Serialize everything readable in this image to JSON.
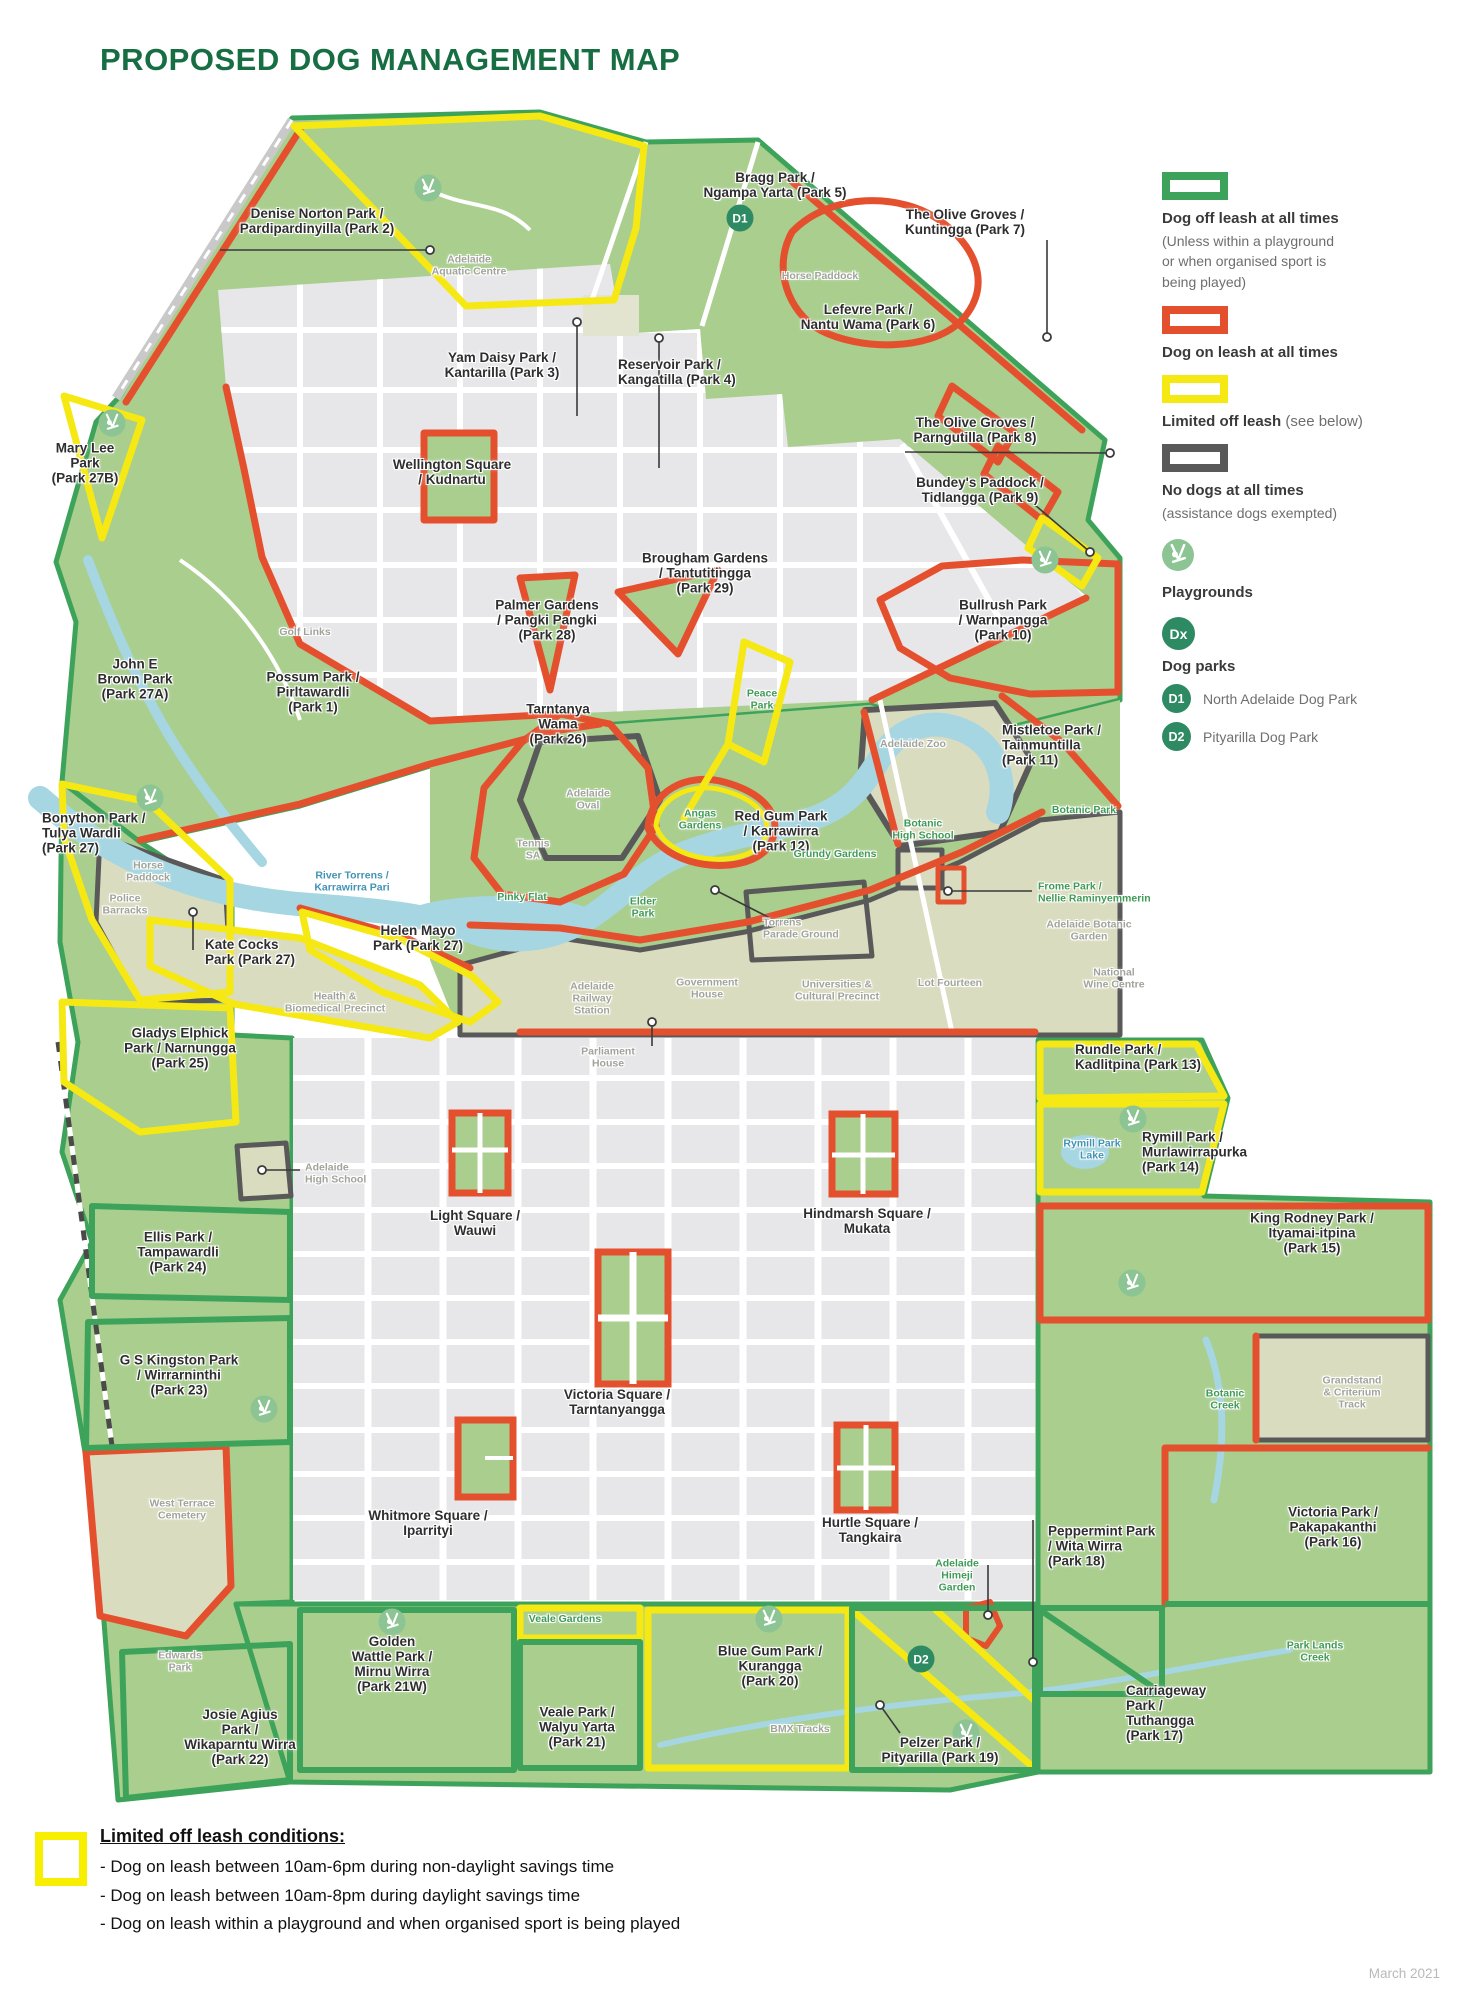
{
  "title": "PROPOSED DOG MANAGEMENT MAP",
  "legend": {
    "off_leash_label": "Dog off leash at all times",
    "off_leash_note": "(Unless within a playground\nor when organised sport is\nbeing played)",
    "on_leash_label": "Dog on leash at all times",
    "limited_label": "Limited off leash",
    "limited_note": " (see below)",
    "no_dogs_label": "No dogs at all times",
    "no_dogs_note": "(assistance dogs exempted)",
    "playgrounds_label": "Playgrounds",
    "dog_parks_badge": "Dx",
    "dog_parks_label": "Dog parks",
    "dog_parks": [
      {
        "badge": "D1",
        "label": "North Adelaide Dog Park"
      },
      {
        "badge": "D2",
        "label": "Pityarilla Dog Park"
      }
    ]
  },
  "footer": {
    "heading": "Limited off leash conditions:",
    "lines": [
      "- Dog on leash between 10am-6pm during non-daylight savings time",
      "- Dog on leash between 10am-8pm during daylight savings time",
      "- Dog on leash within a playground and when organised sport is being played"
    ],
    "date": "March 2021"
  },
  "colors": {
    "off_leash": "#3ea35a",
    "on_leash": "#e4502e",
    "limited": "#f6e813",
    "no_dogs": "#595959",
    "park_fill": "#a9ce8e",
    "water": "#a5d6e2"
  },
  "map_labels": [
    {
      "name": "label-denise-norton",
      "cls": "park",
      "x": 317,
      "y": 221,
      "text": "Denise Norton Park /\nPardipardinyilla (Park 2)"
    },
    {
      "name": "label-bragg",
      "cls": "park",
      "x": 775,
      "y": 185,
      "text": "Bragg Park /\nNgampa Yarta (Park 5)"
    },
    {
      "name": "label-olive-groves-kuntingga",
      "cls": "park",
      "x": 965,
      "y": 222,
      "text": "The Olive Groves /\nKuntingga (Park 7)"
    },
    {
      "name": "label-yam-daisy",
      "cls": "park",
      "x": 502,
      "y": 365,
      "text": "Yam Daisy Park /\nKantarilla (Park 3)"
    },
    {
      "name": "label-reservoir",
      "cls": "park",
      "x": 618,
      "y": 372,
      "align": "left",
      "text": "Reservoir Park /\nKangatilla (Park 4)"
    },
    {
      "name": "label-lefevre",
      "cls": "park",
      "x": 868,
      "y": 317,
      "text": "Lefevre Park /\nNantu Wama (Park 6)"
    },
    {
      "name": "label-olive-groves-parngutilla",
      "cls": "park",
      "x": 975,
      "y": 430,
      "text": "The Olive Groves /\nParngutilla (Park 8)"
    },
    {
      "name": "label-bundeys-paddock",
      "cls": "park",
      "x": 980,
      "y": 490,
      "text": "Bundey's Paddock /\nTidlangga (Park 9)"
    },
    {
      "name": "label-mary-lee",
      "cls": "park",
      "x": 85,
      "y": 463,
      "text": "Mary Lee\nPark\n(Park 27B)"
    },
    {
      "name": "label-wellington-square",
      "cls": "park",
      "x": 452,
      "y": 472,
      "text": "Wellington Square\n/ Kudnartu"
    },
    {
      "name": "label-brougham-gardens",
      "cls": "park",
      "x": 705,
      "y": 573,
      "text": "Brougham Gardens\n/ Tantutitingga\n(Park 29)"
    },
    {
      "name": "label-palmer-gardens",
      "cls": "park",
      "x": 547,
      "y": 620,
      "text": "Palmer Gardens\n/ Pangki Pangki\n(Park 28)"
    },
    {
      "name": "label-bullrush",
      "cls": "park",
      "x": 1003,
      "y": 620,
      "text": "Bullrush Park\n/ Warnpangga\n(Park 10)"
    },
    {
      "name": "label-john-e-brown",
      "cls": "park",
      "x": 135,
      "y": 679,
      "text": "John E\nBrown Park\n(Park 27A)"
    },
    {
      "name": "label-possum",
      "cls": "park",
      "x": 313,
      "y": 692,
      "text": "Possum Park /\nPirltawardli\n(Park 1)"
    },
    {
      "name": "label-tarntanya-wama",
      "cls": "park",
      "x": 558,
      "y": 724,
      "text": "Tarntanya\nWama\n(Park 26)"
    },
    {
      "name": "label-mistletoe",
      "cls": "park",
      "x": 1002,
      "y": 745,
      "align": "left",
      "text": "Mistletoe Park /\nTainmuntilla\n(Park 11)"
    },
    {
      "name": "label-bonython",
      "cls": "park",
      "x": 42,
      "y": 833,
      "align": "left",
      "text": "Bonython Park /\nTulya Wardli\n(Park 27)"
    },
    {
      "name": "label-red-gum",
      "cls": "park",
      "x": 781,
      "y": 831,
      "text": "Red Gum Park\n/ Karrawirra\n(Park 12)"
    },
    {
      "name": "label-kate-cocks",
      "cls": "park",
      "x": 205,
      "y": 952,
      "align": "left",
      "text": "Kate Cocks\nPark (Park 27)"
    },
    {
      "name": "label-helen-mayo",
      "cls": "park",
      "x": 418,
      "y": 938,
      "text": "Helen Mayo\nPark (Park 27)"
    },
    {
      "name": "label-gladys-elphick",
      "cls": "park",
      "x": 180,
      "y": 1048,
      "text": "Gladys Elphick\nPark / Narnungga\n(Park 25)"
    },
    {
      "name": "label-rundle",
      "cls": "park",
      "x": 1075,
      "y": 1057,
      "align": "left",
      "text": "Rundle Park /\nKadlitpina (Park 13)"
    },
    {
      "name": "label-rymill",
      "cls": "park",
      "x": 1142,
      "y": 1152,
      "align": "left",
      "text": "Rymill Park /\nMurlawirrapurka\n(Park 14)"
    },
    {
      "name": "label-light-square",
      "cls": "park",
      "x": 475,
      "y": 1223,
      "text": "Light Square /\nWauwi"
    },
    {
      "name": "label-hindmarsh-square",
      "cls": "park",
      "x": 867,
      "y": 1221,
      "text": "Hindmarsh Square /\nMukata"
    },
    {
      "name": "label-ellis",
      "cls": "park",
      "x": 178,
      "y": 1252,
      "text": "Ellis Park /\nTampawardli\n(Park 24)"
    },
    {
      "name": "label-king-rodney",
      "cls": "park",
      "x": 1312,
      "y": 1233,
      "text": "King Rodney Park /\nItyamai-itpina\n(Park 15)"
    },
    {
      "name": "label-gs-kingston",
      "cls": "park",
      "x": 179,
      "y": 1375,
      "text": "G S Kingston Park\n/ Wirrarninthi\n(Park 23)"
    },
    {
      "name": "label-victoria-square",
      "cls": "park",
      "x": 617,
      "y": 1402,
      "text": "Victoria Square /\nTarntanyangga"
    },
    {
      "name": "label-whitmore-square",
      "cls": "park",
      "x": 428,
      "y": 1523,
      "text": "Whitmore Square /\nIparrityi"
    },
    {
      "name": "label-hurtle-square",
      "cls": "park",
      "x": 870,
      "y": 1530,
      "text": "Hurtle Square /\nTangkaira"
    },
    {
      "name": "label-peppermint",
      "cls": "park",
      "x": 1048,
      "y": 1546,
      "align": "left",
      "text": "Peppermint Park\n/ Wita Wirra\n(Park 18)"
    },
    {
      "name": "label-victoria-park",
      "cls": "park",
      "x": 1333,
      "y": 1527,
      "text": "Victoria Park /\nPakapakanthi\n(Park 16)"
    },
    {
      "name": "label-golden-wattle",
      "cls": "park",
      "x": 392,
      "y": 1664,
      "text": "Golden\nWattle Park /\nMirnu Wirra\n(Park 21W)"
    },
    {
      "name": "label-blue-gum",
      "cls": "park",
      "x": 770,
      "y": 1666,
      "text": "Blue Gum Park /\nKurangga\n(Park 20)"
    },
    {
      "name": "label-veale-park",
      "cls": "park",
      "x": 577,
      "y": 1727,
      "text": "Veale Park /\nWalyu Yarta\n(Park 21)"
    },
    {
      "name": "label-carriageway",
      "cls": "park",
      "x": 1126,
      "y": 1713,
      "align": "left",
      "text": "Carriageway\nPark /\nTuthangga\n(Park 17)"
    },
    {
      "name": "label-josie-agius",
      "cls": "park",
      "x": 240,
      "y": 1737,
      "text": "Josie Agius\nPark /\nWikaparntu Wirra\n(Park 22)"
    },
    {
      "name": "label-pelzer",
      "cls": "park",
      "x": 940,
      "y": 1750,
      "text": "Pelzer Park /\nPityarilla (Park 19)"
    },
    {
      "name": "label-peace-park",
      "cls": "green",
      "x": 762,
      "y": 700,
      "text": "Peace\nPark"
    },
    {
      "name": "label-botanic-park",
      "cls": "green",
      "x": 1084,
      "y": 811,
      "text": "Botanic Park"
    },
    {
      "name": "label-angas-gardens",
      "cls": "green",
      "x": 700,
      "y": 820,
      "text": "Angas\nGardens"
    },
    {
      "name": "label-grundy-gardens",
      "cls": "green",
      "x": 835,
      "y": 855,
      "text": "Grundy Gardens"
    },
    {
      "name": "label-botanic-high-school",
      "cls": "green",
      "x": 923,
      "y": 830,
      "text": "Botanic\nHigh School"
    },
    {
      "name": "label-frome-park",
      "cls": "green",
      "x": 1038,
      "y": 893,
      "align": "left",
      "text": "Frome Park /\nNellie Raminyemmerin"
    },
    {
      "name": "label-pinky-flat",
      "cls": "green",
      "x": 522,
      "y": 898,
      "text": "Pinky Flat"
    },
    {
      "name": "label-elder-park",
      "cls": "green",
      "x": 643,
      "y": 908,
      "text": "Elder\nPark"
    },
    {
      "name": "label-veale-gardens",
      "cls": "green",
      "x": 565,
      "y": 1620,
      "text": "Veale Gardens"
    },
    {
      "name": "label-himeji-garden",
      "cls": "green",
      "x": 957,
      "y": 1576,
      "text": "Adelaide\nHimeji\nGarden"
    },
    {
      "name": "label-park-lands-creek",
      "cls": "green",
      "x": 1315,
      "y": 1652,
      "text": "Park Lands\nCreek"
    },
    {
      "name": "label-botanic-creek",
      "cls": "green",
      "x": 1225,
      "y": 1400,
      "text": "Botanic\nCreek"
    },
    {
      "name": "label-river-torrens",
      "cls": "blue",
      "x": 352,
      "y": 882,
      "text": "River Torrens /\nKarrawirra Pari"
    },
    {
      "name": "label-rymill-lake",
      "cls": "blue",
      "x": 1092,
      "y": 1150,
      "text": "Rymill Park\nLake"
    },
    {
      "name": "label-aquatic-centre",
      "cls": "gray",
      "x": 469,
      "y": 266,
      "text": "Adelaide\nAquatic Centre"
    },
    {
      "name": "label-horse-paddock-north",
      "cls": "gray",
      "x": 820,
      "y": 277,
      "text": "Horse Paddock"
    },
    {
      "name": "label-golf-links",
      "cls": "gray",
      "x": 305,
      "y": 633,
      "text": "Golf Links"
    },
    {
      "name": "label-adelaide-zoo",
      "cls": "gray",
      "x": 913,
      "y": 745,
      "text": "Adelaide Zoo"
    },
    {
      "name": "label-adelaide-oval",
      "cls": "gray",
      "x": 588,
      "y": 800,
      "text": "Adelaide\nOval"
    },
    {
      "name": "label-tennis-sa",
      "cls": "gray",
      "x": 533,
      "y": 850,
      "text": "Tennis\nSA"
    },
    {
      "name": "label-horse-paddock-west",
      "cls": "gray",
      "x": 148,
      "y": 872,
      "text": "Horse\nPaddock"
    },
    {
      "name": "label-police-barracks",
      "cls": "gray",
      "x": 125,
      "y": 905,
      "text": "Police\nBarracks"
    },
    {
      "name": "label-torrens-parade-ground",
      "cls": "gray",
      "x": 763,
      "y": 929,
      "align": "left",
      "text": "Torrens\nParade Ground"
    },
    {
      "name": "label-health-biomedical",
      "cls": "gray",
      "x": 335,
      "y": 1003,
      "text": "Health &\nBiomedical Precinct"
    },
    {
      "name": "label-railway-station",
      "cls": "gray",
      "x": 592,
      "y": 999,
      "text": "Adelaide\nRailway\nStation"
    },
    {
      "name": "label-government-house",
      "cls": "gray",
      "x": 707,
      "y": 989,
      "text": "Government\nHouse"
    },
    {
      "name": "label-universities",
      "cls": "gray",
      "x": 837,
      "y": 991,
      "text": "Universities &\nCultural Precinct"
    },
    {
      "name": "label-lot-fourteen",
      "cls": "gray",
      "x": 950,
      "y": 984,
      "text": "Lot Fourteen"
    },
    {
      "name": "label-wine-centre",
      "cls": "gray",
      "x": 1114,
      "y": 979,
      "text": "National\nWine Centre"
    },
    {
      "name": "label-botanic-garden",
      "cls": "gray",
      "x": 1089,
      "y": 931,
      "text": "Adelaide Botanic\nGarden"
    },
    {
      "name": "label-parliament-house",
      "cls": "gray",
      "x": 608,
      "y": 1058,
      "text": "Parliament\nHouse"
    },
    {
      "name": "label-adelaide-high-school",
      "cls": "gray",
      "x": 305,
      "y": 1174,
      "align": "left",
      "text": "Adelaide\nHigh School"
    },
    {
      "name": "label-west-terrace-cemetery",
      "cls": "gray",
      "x": 182,
      "y": 1510,
      "text": "West Terrace\nCemetery"
    },
    {
      "name": "label-grandstand",
      "cls": "gray",
      "x": 1352,
      "y": 1393,
      "text": "Grandstand\n& Criterium\nTrack"
    },
    {
      "name": "label-edwards-park",
      "cls": "gray",
      "x": 180,
      "y": 1662,
      "text": "Edwards\nPark"
    },
    {
      "name": "label-bmx-tracks",
      "cls": "gray",
      "x": 800,
      "y": 1730,
      "text": "BMX Tracks"
    }
  ],
  "map_markers": {
    "playgrounds": [
      [
        428,
        188
      ],
      [
        112,
        423
      ],
      [
        150,
        798
      ],
      [
        1045,
        560
      ],
      [
        1133,
        1119
      ],
      [
        1132,
        1283
      ],
      [
        264,
        1409
      ],
      [
        392,
        1622
      ],
      [
        769,
        1619
      ],
      [
        966,
        1733
      ]
    ],
    "dog_parks": [
      {
        "x": 740,
        "y": 218,
        "label": "D1"
      },
      {
        "x": 921,
        "y": 1659,
        "label": "D2"
      }
    ]
  },
  "leader_lines": [
    [
      220,
      250,
      430,
      250,
      "end"
    ],
    [
      577,
      322,
      577,
      416,
      "start"
    ],
    [
      659,
      338,
      659,
      468,
      "start"
    ],
    [
      1047,
      240,
      1047,
      337,
      "end"
    ],
    [
      905,
      452,
      1110,
      453,
      "end"
    ],
    [
      1035,
      505,
      1090,
      552,
      "end"
    ],
    [
      193,
      912,
      193,
      950,
      "start"
    ],
    [
      948,
      891,
      1032,
      891,
      "start"
    ],
    [
      715,
      890,
      770,
      918,
      "start"
    ],
    [
      262,
      1170,
      300,
      1170,
      "start"
    ],
    [
      652,
      1022,
      652,
      1046,
      "start"
    ],
    [
      1033,
      1520,
      1033,
      1662,
      "end"
    ],
    [
      988,
      1565,
      988,
      1615,
      "end"
    ],
    [
      900,
      1733,
      880,
      1705,
      "end"
    ]
  ]
}
